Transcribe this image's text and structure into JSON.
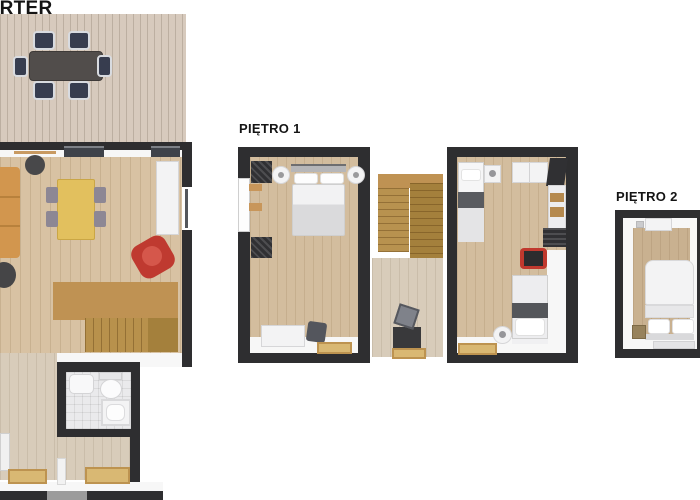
{
  "labels": {
    "parter": "PARTER",
    "pietro1": "PIĘTRO 1",
    "pietro2": "PIĘTRO 2"
  },
  "palette": {
    "background": "#ffffff",
    "wall": "#2e2e30",
    "wood_floor": "#d8c2a3",
    "terrace_deck": "#d7cabd",
    "stairs_wood": "#b8914c",
    "bathroom_tile": "#eaeaec",
    "sofa_orange": "#d2964e",
    "dining_table_yellow": "#e2c05e",
    "armchair_red": "#c0392e",
    "doormat_tan": "#d9b873",
    "white_furniture": "#f3f3f4"
  },
  "floors": [
    {
      "id": "parter",
      "rooms": [
        "terrace",
        "living-dining-room",
        "staircase",
        "bathroom",
        "entry-hall"
      ]
    },
    {
      "id": "pietro1",
      "rooms": [
        "bedroom-1",
        "stair-hall",
        "bedroom-2"
      ]
    },
    {
      "id": "pietro2",
      "rooms": [
        "bedroom-3"
      ]
    }
  ]
}
